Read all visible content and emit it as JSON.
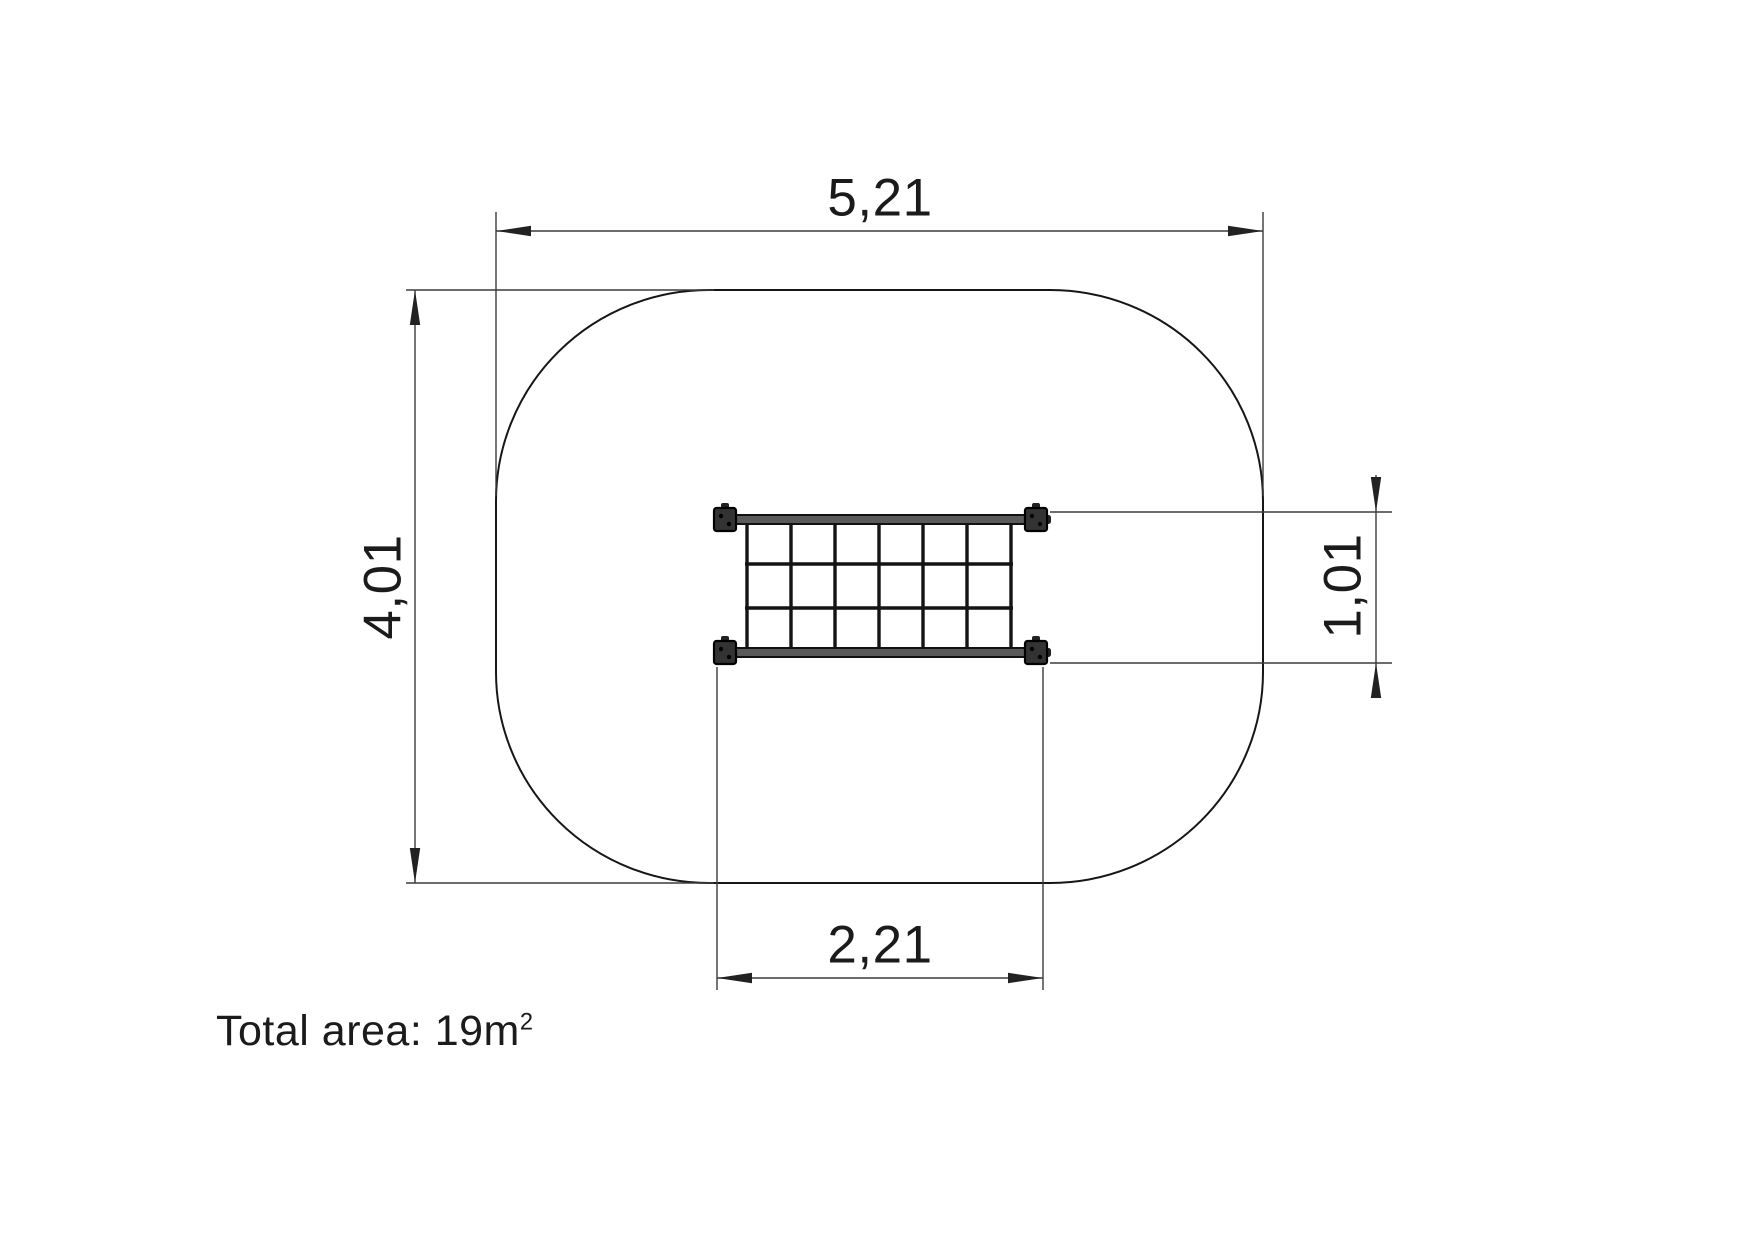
{
  "drawing": {
    "kind": "playground-net-plan-view",
    "dimensions": {
      "safety_area_width": "5,21",
      "safety_area_height": "4,01",
      "net_width": "2,21",
      "net_height": "1,01"
    },
    "total_area": {
      "text": "Total area: 19m",
      "superscript": "2"
    },
    "net": {
      "columns": 6,
      "rows": 3
    },
    "colors": {
      "background": "#ffffff",
      "outline": "#161616",
      "thin_line": "#3b3b3b",
      "text": "#1b1b1b",
      "rail_fill": "#5a5a5a",
      "post_fill": "#333333",
      "rope": "#141414"
    }
  }
}
